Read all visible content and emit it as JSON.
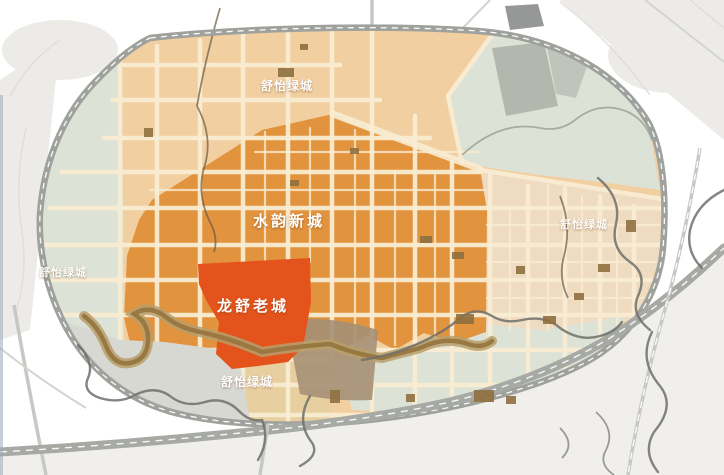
{
  "map": {
    "labels": {
      "new_city": "水韵新城",
      "old_city": "龙舒老城",
      "district_top": "舒怡绿城",
      "district_left": "舒怡绿城",
      "district_right": "舒怡绿城",
      "district_bottom": "舒怡绿城"
    },
    "colors": {
      "background": "#ffffff",
      "edge_line": "#9aa8bc",
      "outskirt_wash": "#ecebe7",
      "zone_light": "#f1cfa1",
      "zone_east": "#eedbc0",
      "zone_dark": "#e2933d",
      "zone_old_city": "#e5531c",
      "zone_green": "#dde2d6",
      "zone_gray_patch": "#a9aca4",
      "floodplain": "#d8d8d3",
      "wetland": "#a59076",
      "zone_olive": "#e7cf9f",
      "road_fill": "#f8ecd2",
      "ring_road": "#9fa19c",
      "highway": "#a7a9a4",
      "road_dash": "#ffffff",
      "river_brown": "#97763f",
      "river_bank": "#b79f6b",
      "river_gray": "#6e706b",
      "building_block": "#8f7040",
      "label_text": "#ffffff"
    }
  }
}
